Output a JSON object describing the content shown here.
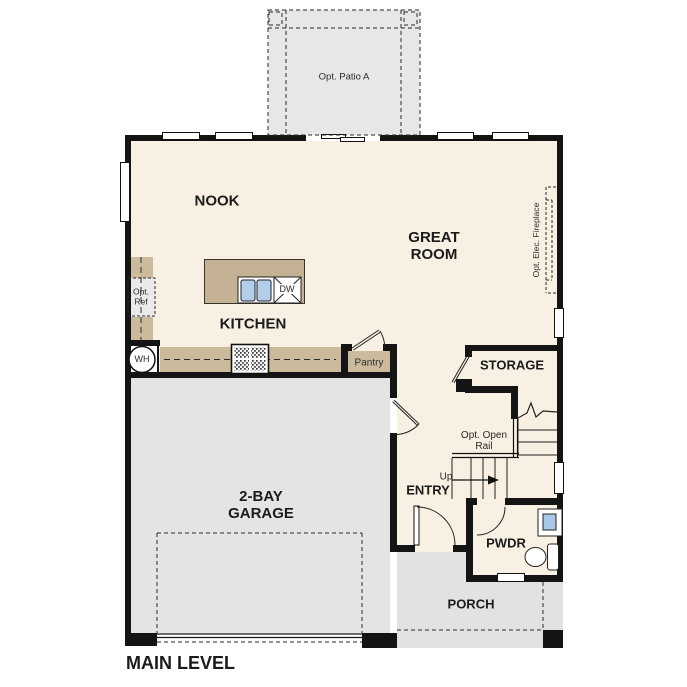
{
  "plan_title": "MAIN LEVEL",
  "rooms": {
    "nook": "NOOK",
    "kitchen": "KITCHEN",
    "great_room": "GREAT ROOM",
    "garage": "2-BAY GARAGE",
    "entry": "ENTRY",
    "storage": "STORAGE",
    "powder": "PWDR",
    "porch": "PORCH"
  },
  "annotations": {
    "patio": "Opt. Patio A",
    "fireplace": "Opt. Elec. Fireplace",
    "open_rail": "Opt. Open Rail",
    "up": "Up",
    "pantry": "Pantry",
    "opt_ref": "Opt. Ref",
    "water_heater": "WH",
    "dishwasher": "DW"
  },
  "colors": {
    "floor": "#f8f0e2",
    "garage_floor": "#e4e4e3",
    "porch_floor": "#e2e2e1",
    "patio_floor": "#e7e7e6",
    "counter": "#cbbb9c",
    "island": "#c5b294",
    "sink_fixture": "#b4cfe9",
    "wall": "#141414"
  }
}
